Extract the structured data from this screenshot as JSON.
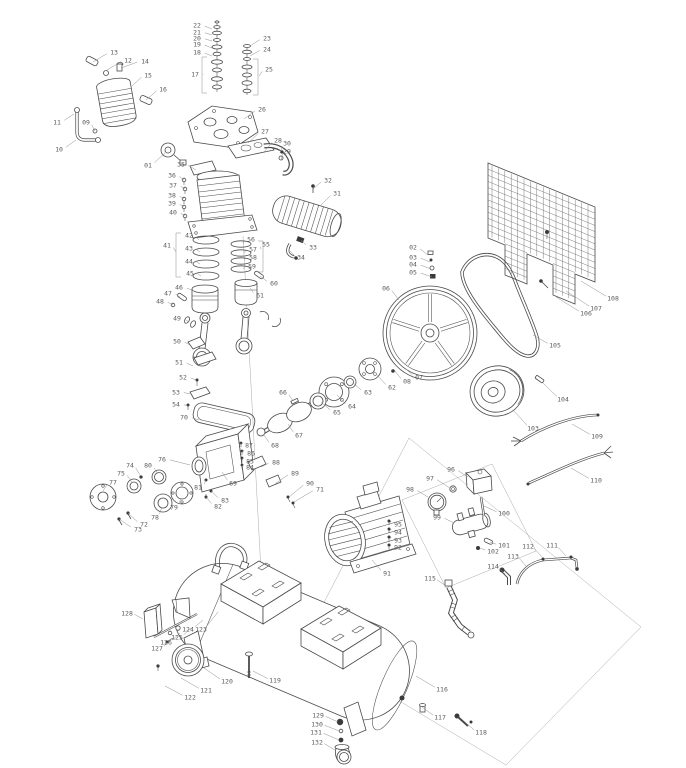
{
  "canvas": {
    "width": 686,
    "height": 768
  },
  "colors": {
    "background": "#ffffff",
    "line": "#4a4a4a",
    "leader": "#8d8d8d",
    "label": "#5a5a5a"
  },
  "diagram": {
    "type": "exploded-parts-diagram",
    "callouts": [
      {
        "n": "01",
        "x": 148,
        "y": 165,
        "tx": 166,
        "ty": 152
      },
      {
        "n": "02",
        "x": 413,
        "y": 247,
        "tx": 428,
        "ty": 255
      },
      {
        "n": "03",
        "x": 413,
        "y": 257,
        "tx": 430,
        "ty": 262
      },
      {
        "n": "04",
        "x": 413,
        "y": 264,
        "tx": 431,
        "ty": 269
      },
      {
        "n": "05",
        "x": 413,
        "y": 272,
        "tx": 432,
        "ty": 277
      },
      {
        "n": "06",
        "x": 386,
        "y": 288,
        "tx": 399,
        "ty": 300
      },
      {
        "n": "07",
        "x": 419,
        "y": 377,
        "tx": 405,
        "ty": 368
      },
      {
        "n": "08",
        "x": 407,
        "y": 381,
        "tx": 395,
        "ty": 371
      },
      {
        "n": "09",
        "x": 86,
        "y": 122,
        "tx": 95,
        "ty": 131
      },
      {
        "n": "10",
        "x": 59,
        "y": 149,
        "tx": 76,
        "ty": 140
      },
      {
        "n": "11",
        "x": 57,
        "y": 122,
        "tx": 74,
        "ty": 114
      },
      {
        "n": "12",
        "x": 128,
        "y": 60,
        "tx": 107,
        "ty": 70
      },
      {
        "n": "13",
        "x": 114,
        "y": 52,
        "tx": 93,
        "ty": 62
      },
      {
        "n": "14",
        "x": 145,
        "y": 61,
        "tx": 121,
        "ty": 68
      },
      {
        "n": "15",
        "x": 148,
        "y": 75,
        "tx": 132,
        "ty": 86
      },
      {
        "n": "16",
        "x": 163,
        "y": 89,
        "tx": 146,
        "ty": 100
      },
      {
        "n": "17",
        "x": 195,
        "y": 74,
        "tx": 203,
        "ty": 75
      },
      {
        "n": "18",
        "x": 197,
        "y": 52,
        "tx": 212,
        "ty": 56
      },
      {
        "n": "19",
        "x": 197,
        "y": 44,
        "tx": 212,
        "ty": 48
      },
      {
        "n": "20",
        "x": 197,
        "y": 38,
        "tx": 212,
        "ty": 41
      },
      {
        "n": "21",
        "x": 197,
        "y": 32,
        "tx": 212,
        "ty": 35
      },
      {
        "n": "22",
        "x": 197,
        "y": 25,
        "tx": 212,
        "ty": 29
      },
      {
        "n": "23",
        "x": 267,
        "y": 38,
        "tx": 250,
        "ty": 46
      },
      {
        "n": "24",
        "x": 267,
        "y": 49,
        "tx": 250,
        "ty": 56
      },
      {
        "n": "25",
        "x": 269,
        "y": 69,
        "tx": 259,
        "ty": 76
      },
      {
        "n": "26",
        "x": 262,
        "y": 109,
        "tx": 244,
        "ty": 119
      },
      {
        "n": "27",
        "x": 265,
        "y": 131,
        "tx": 248,
        "ty": 143
      },
      {
        "n": "28",
        "x": 278,
        "y": 140,
        "tx": 264,
        "ty": 152
      },
      {
        "n": "29",
        "x": 287,
        "y": 151,
        "tx": 281,
        "ty": 160
      },
      {
        "n": "30",
        "x": 287,
        "y": 143,
        "tx": 280,
        "ty": 153
      },
      {
        "n": "31",
        "x": 337,
        "y": 193,
        "tx": 321,
        "ty": 205
      },
      {
        "n": "32",
        "x": 328,
        "y": 180,
        "tx": 313,
        "ty": 189
      },
      {
        "n": "33",
        "x": 313,
        "y": 247,
        "tx": 301,
        "ty": 240
      },
      {
        "n": "34",
        "x": 301,
        "y": 257,
        "tx": 290,
        "ty": 251
      },
      {
        "n": "35",
        "x": 181,
        "y": 164,
        "tx": 196,
        "ty": 170
      },
      {
        "n": "36",
        "x": 172,
        "y": 175,
        "tx": 184,
        "ty": 180
      },
      {
        "n": "37",
        "x": 173,
        "y": 185,
        "tx": 185,
        "ty": 189
      },
      {
        "n": "38",
        "x": 172,
        "y": 195,
        "tx": 184,
        "ty": 199
      },
      {
        "n": "39",
        "x": 172,
        "y": 203,
        "tx": 184,
        "ty": 207
      },
      {
        "n": "40",
        "x": 173,
        "y": 212,
        "tx": 185,
        "ty": 216
      },
      {
        "n": "41",
        "x": 167,
        "y": 245,
        "tx": 176,
        "ty": 252
      },
      {
        "n": "42",
        "x": 189,
        "y": 235,
        "tx": 199,
        "ty": 240
      },
      {
        "n": "43",
        "x": 189,
        "y": 248,
        "tx": 200,
        "ty": 252
      },
      {
        "n": "44",
        "x": 189,
        "y": 261,
        "tx": 200,
        "ty": 264
      },
      {
        "n": "45",
        "x": 190,
        "y": 273,
        "tx": 201,
        "ty": 276
      },
      {
        "n": "46",
        "x": 179,
        "y": 287,
        "tx": 194,
        "ty": 291
      },
      {
        "n": "47",
        "x": 168,
        "y": 293,
        "tx": 180,
        "ty": 297
      },
      {
        "n": "48",
        "x": 160,
        "y": 301,
        "tx": 173,
        "ty": 305
      },
      {
        "n": "49",
        "x": 177,
        "y": 318,
        "tx": 189,
        "ty": 322
      },
      {
        "n": "50",
        "x": 177,
        "y": 341,
        "tx": 190,
        "ty": 345
      },
      {
        "n": "51",
        "x": 179,
        "y": 362,
        "tx": 193,
        "ty": 366
      },
      {
        "n": "52",
        "x": 183,
        "y": 377,
        "tx": 196,
        "ty": 380
      },
      {
        "n": "53",
        "x": 176,
        "y": 392,
        "tx": 190,
        "ty": 394
      },
      {
        "n": "54",
        "x": 176,
        "y": 404,
        "tx": 188,
        "ty": 406
      },
      {
        "n": "55",
        "x": 266,
        "y": 244,
        "tx": 261,
        "ty": 249
      },
      {
        "n": "56",
        "x": 251,
        "y": 239,
        "tx": 243,
        "ty": 244
      },
      {
        "n": "57",
        "x": 253,
        "y": 249,
        "tx": 244,
        "ty": 253
      },
      {
        "n": "58",
        "x": 253,
        "y": 257,
        "tx": 244,
        "ty": 260
      },
      {
        "n": "59",
        "x": 252,
        "y": 266,
        "tx": 243,
        "ty": 269
      },
      {
        "n": "60",
        "x": 274,
        "y": 283,
        "tx": 260,
        "ty": 276
      },
      {
        "n": "61",
        "x": 260,
        "y": 295,
        "tx": 250,
        "ty": 288
      },
      {
        "n": "62",
        "x": 392,
        "y": 387,
        "tx": 376,
        "ty": 374
      },
      {
        "n": "63",
        "x": 368,
        "y": 392,
        "tx": 353,
        "ty": 383
      },
      {
        "n": "64",
        "x": 352,
        "y": 406,
        "tx": 337,
        "ty": 395
      },
      {
        "n": "65",
        "x": 337,
        "y": 412,
        "tx": 321,
        "ty": 402
      },
      {
        "n": "66",
        "x": 283,
        "y": 392,
        "tx": 293,
        "ty": 401
      },
      {
        "n": "67",
        "x": 299,
        "y": 435,
        "tx": 288,
        "ty": 424
      },
      {
        "n": "68",
        "x": 275,
        "y": 445,
        "tx": 263,
        "ty": 434
      },
      {
        "n": "69",
        "x": 233,
        "y": 483,
        "tx": 222,
        "ty": 472
      },
      {
        "n": "70",
        "x": 184,
        "y": 417,
        "tx": 199,
        "ty": 420
      },
      {
        "n": "71",
        "x": 320,
        "y": 489,
        "tx": 294,
        "ty": 502
      },
      {
        "n": "72",
        "x": 144,
        "y": 524,
        "tx": 128,
        "ty": 513
      },
      {
        "n": "73",
        "x": 138,
        "y": 529,
        "tx": 119,
        "ty": 519
      },
      {
        "n": "74",
        "x": 130,
        "y": 465,
        "tx": 140,
        "ty": 475
      },
      {
        "n": "75",
        "x": 121,
        "y": 473,
        "tx": 132,
        "ty": 482
      },
      {
        "n": "76",
        "x": 162,
        "y": 459,
        "tx": 190,
        "ty": 465
      },
      {
        "n": "77",
        "x": 113,
        "y": 482,
        "tx": 103,
        "ty": 491
      },
      {
        "n": "78",
        "x": 155,
        "y": 517,
        "tx": 162,
        "ty": 507
      },
      {
        "n": "79",
        "x": 174,
        "y": 507,
        "tx": 181,
        "ty": 498
      },
      {
        "n": "80",
        "x": 148,
        "y": 465,
        "tx": 158,
        "ty": 474
      },
      {
        "n": "81",
        "x": 198,
        "y": 487,
        "tx": 206,
        "ty": 480
      },
      {
        "n": "82",
        "x": 218,
        "y": 506,
        "tx": 206,
        "ty": 497
      },
      {
        "n": "83",
        "x": 225,
        "y": 500,
        "tx": 211,
        "ty": 491
      },
      {
        "n": "84",
        "x": 250,
        "y": 467,
        "tx": 242,
        "ty": 465
      },
      {
        "n": "85",
        "x": 250,
        "y": 461,
        "tx": 242,
        "ty": 458
      },
      {
        "n": "86",
        "x": 251,
        "y": 453,
        "tx": 242,
        "ty": 451
      },
      {
        "n": "87",
        "x": 249,
        "y": 445,
        "tx": 241,
        "ty": 443
      },
      {
        "n": "88",
        "x": 276,
        "y": 462,
        "tx": 261,
        "ty": 467
      },
      {
        "n": "89",
        "x": 295,
        "y": 473,
        "tx": 275,
        "ty": 484
      },
      {
        "n": "90",
        "x": 310,
        "y": 483,
        "tx": 289,
        "ty": 497
      },
      {
        "n": "91",
        "x": 387,
        "y": 573,
        "tx": 372,
        "ty": 560
      },
      {
        "n": "92",
        "x": 398,
        "y": 547,
        "tx": 391,
        "ty": 545
      },
      {
        "n": "93",
        "x": 398,
        "y": 540,
        "tx": 391,
        "ty": 537
      },
      {
        "n": "94",
        "x": 398,
        "y": 532,
        "tx": 391,
        "ty": 529
      },
      {
        "n": "95",
        "x": 398,
        "y": 524,
        "tx": 391,
        "ty": 521
      },
      {
        "n": "96",
        "x": 451,
        "y": 469,
        "tx": 468,
        "ty": 477
      },
      {
        "n": "97",
        "x": 430,
        "y": 478,
        "tx": 450,
        "ty": 488
      },
      {
        "n": "98",
        "x": 410,
        "y": 489,
        "tx": 428,
        "ty": 497
      },
      {
        "n": "99",
        "x": 437,
        "y": 517,
        "tx": 454,
        "ty": 523
      },
      {
        "n": "100",
        "x": 504,
        "y": 513,
        "tx": 484,
        "ty": 506
      },
      {
        "n": "101",
        "x": 504,
        "y": 545,
        "tx": 490,
        "ty": 542
      },
      {
        "n": "102",
        "x": 493,
        "y": 551,
        "tx": 480,
        "ty": 548
      },
      {
        "n": "103",
        "x": 533,
        "y": 428,
        "tx": 513,
        "ty": 410
      },
      {
        "n": "104",
        "x": 563,
        "y": 399,
        "tx": 543,
        "ty": 383
      },
      {
        "n": "105",
        "x": 555,
        "y": 345,
        "tx": 533,
        "ty": 335
      },
      {
        "n": "106",
        "x": 586,
        "y": 313,
        "tx": 556,
        "ty": 297
      },
      {
        "n": "107",
        "x": 596,
        "y": 308,
        "tx": 566,
        "ty": 291
      },
      {
        "n": "108",
        "x": 613,
        "y": 298,
        "tx": 581,
        "ty": 281
      },
      {
        "n": "109",
        "x": 597,
        "y": 436,
        "tx": 572,
        "ty": 424
      },
      {
        "n": "110",
        "x": 596,
        "y": 480,
        "tx": 571,
        "ty": 468
      },
      {
        "n": "111",
        "x": 552,
        "y": 545,
        "tx": 566,
        "ty": 556
      },
      {
        "n": "112",
        "x": 528,
        "y": 546,
        "tx": 542,
        "ty": 557
      },
      {
        "n": "113",
        "x": 513,
        "y": 556,
        "tx": 526,
        "ty": 566
      },
      {
        "n": "114",
        "x": 493,
        "y": 566,
        "tx": 505,
        "ty": 574
      },
      {
        "n": "115",
        "x": 430,
        "y": 578,
        "tx": 446,
        "ty": 586
      },
      {
        "n": "116",
        "x": 442,
        "y": 689,
        "tx": 416,
        "ty": 676
      },
      {
        "n": "117",
        "x": 440,
        "y": 717,
        "tx": 422,
        "ty": 707
      },
      {
        "n": "118",
        "x": 481,
        "y": 732,
        "tx": 466,
        "ty": 723
      },
      {
        "n": "119",
        "x": 275,
        "y": 680,
        "tx": 253,
        "ty": 671
      },
      {
        "n": "120",
        "x": 227,
        "y": 681,
        "tx": 204,
        "ty": 668
      },
      {
        "n": "121",
        "x": 206,
        "y": 690,
        "tx": 181,
        "ty": 678
      },
      {
        "n": "122",
        "x": 190,
        "y": 697,
        "tx": 165,
        "ty": 686
      },
      {
        "n": "123",
        "x": 201,
        "y": 629,
        "tx": 218,
        "ty": 612
      },
      {
        "n": "124",
        "x": 188,
        "y": 629,
        "tx": 203,
        "ty": 620
      },
      {
        "n": "125",
        "x": 177,
        "y": 637,
        "tx": 191,
        "ty": 628
      },
      {
        "n": "126",
        "x": 166,
        "y": 642,
        "tx": 180,
        "ty": 633
      },
      {
        "n": "127",
        "x": 157,
        "y": 648,
        "tx": 170,
        "ty": 641
      },
      {
        "n": "128",
        "x": 127,
        "y": 613,
        "tx": 143,
        "ty": 619
      },
      {
        "n": "129",
        "x": 318,
        "y": 715,
        "tx": 338,
        "ty": 722
      },
      {
        "n": "130",
        "x": 317,
        "y": 724,
        "tx": 339,
        "ty": 731
      },
      {
        "n": "131",
        "x": 316,
        "y": 732,
        "tx": 339,
        "ty": 740
      },
      {
        "n": "132",
        "x": 317,
        "y": 742,
        "tx": 335,
        "ty": 750
      }
    ]
  }
}
